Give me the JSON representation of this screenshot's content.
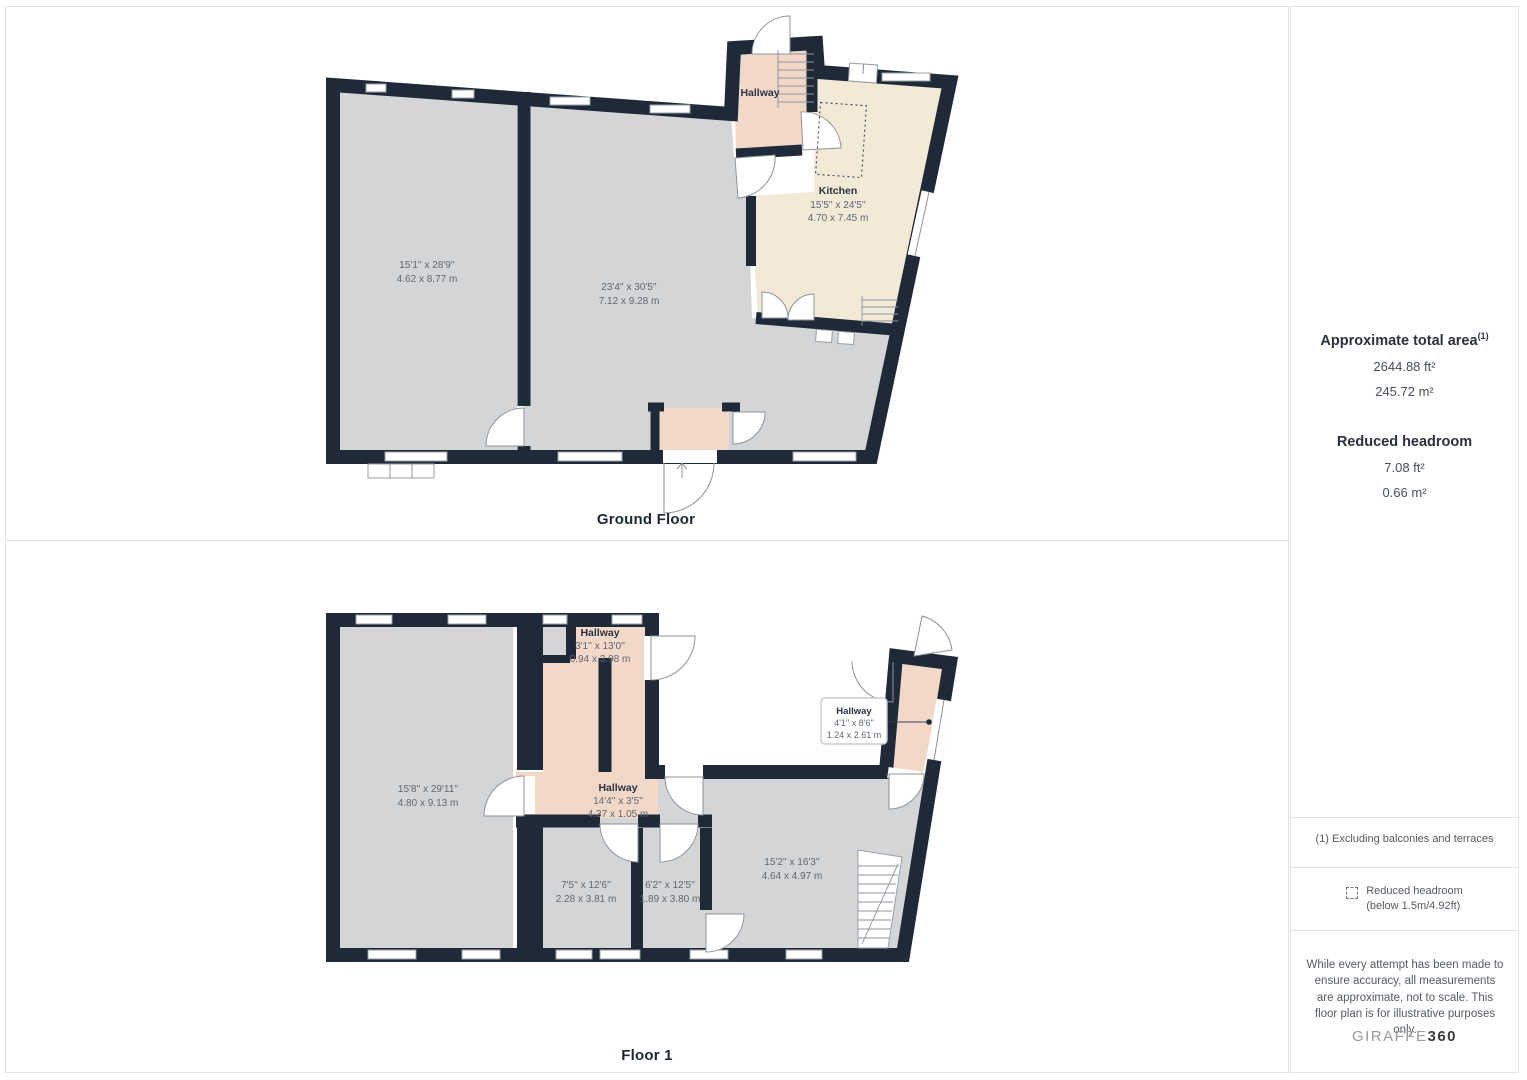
{
  "ground_floor": {
    "title": "Ground Floor",
    "hallway": {
      "name": "Hallway"
    },
    "room_left": {
      "imperial": "15'1'' x 28'9''",
      "metric": "4.62 x 8.77 m"
    },
    "room_main": {
      "imperial": "23'4'' x 30'5''",
      "metric": "7.12 x 9.28 m"
    },
    "kitchen": {
      "name": "Kitchen",
      "imperial": "15'5'' x 24'5''",
      "metric": "4.70 x 7.45 m"
    }
  },
  "floor_1": {
    "title": "Floor 1",
    "hallway_top": {
      "name": "Hallway",
      "imperial": "3'1'' x 13'0''",
      "metric": "0.94 x 3.98 m"
    },
    "hallway_mid": {
      "name": "Hallway",
      "imperial": "14'4'' x 3'5''",
      "metric": "4.37 x 1.05 m"
    },
    "hallway_right": {
      "name": "Hallway",
      "imperial": "4'1'' x 8'6''",
      "metric": "1.24 x 2.61 m"
    },
    "room_left": {
      "imperial": "15'8'' x 29'11''",
      "metric": "4.80 x 9.13 m"
    },
    "room_a": {
      "imperial": "7'5'' x 12'6''",
      "metric": "2.28 x 3.81 m"
    },
    "room_b": {
      "imperial": "6'2'' x 12'5''",
      "metric": "1.89 x 3.80 m"
    },
    "room_right": {
      "imperial": "15'2'' x 16'3''",
      "metric": "4.64 x 4.97 m"
    }
  },
  "sidebar": {
    "total_area_label": "Approximate total area",
    "total_area_sup": "(1)",
    "total_area_ft": "2644.88 ft²",
    "total_area_m": "245.72 m²",
    "reduced_headroom_label": "Reduced headroom",
    "reduced_headroom_ft": "7.08 ft²",
    "reduced_headroom_m": "0.66 m²",
    "footnote": "(1) Excluding balconies and terraces",
    "legend_line1": "Reduced headroom",
    "legend_line2": "(below 1.5m/4.92ft)",
    "disclaimer": "While every attempt has been made to ensure accuracy, all measurements are approximate, not to scale. This floor plan is for illustrative purposes only.",
    "brand_giraffe": "GIRAFFE",
    "brand_360": "360"
  },
  "colors": {
    "wall": "#1e2a38",
    "room_fill": "#d3d5d7",
    "kitchen_fill": "#f2e9d6",
    "hallway_fill": "#f2d8c9",
    "divider": "#e4e4e4"
  }
}
